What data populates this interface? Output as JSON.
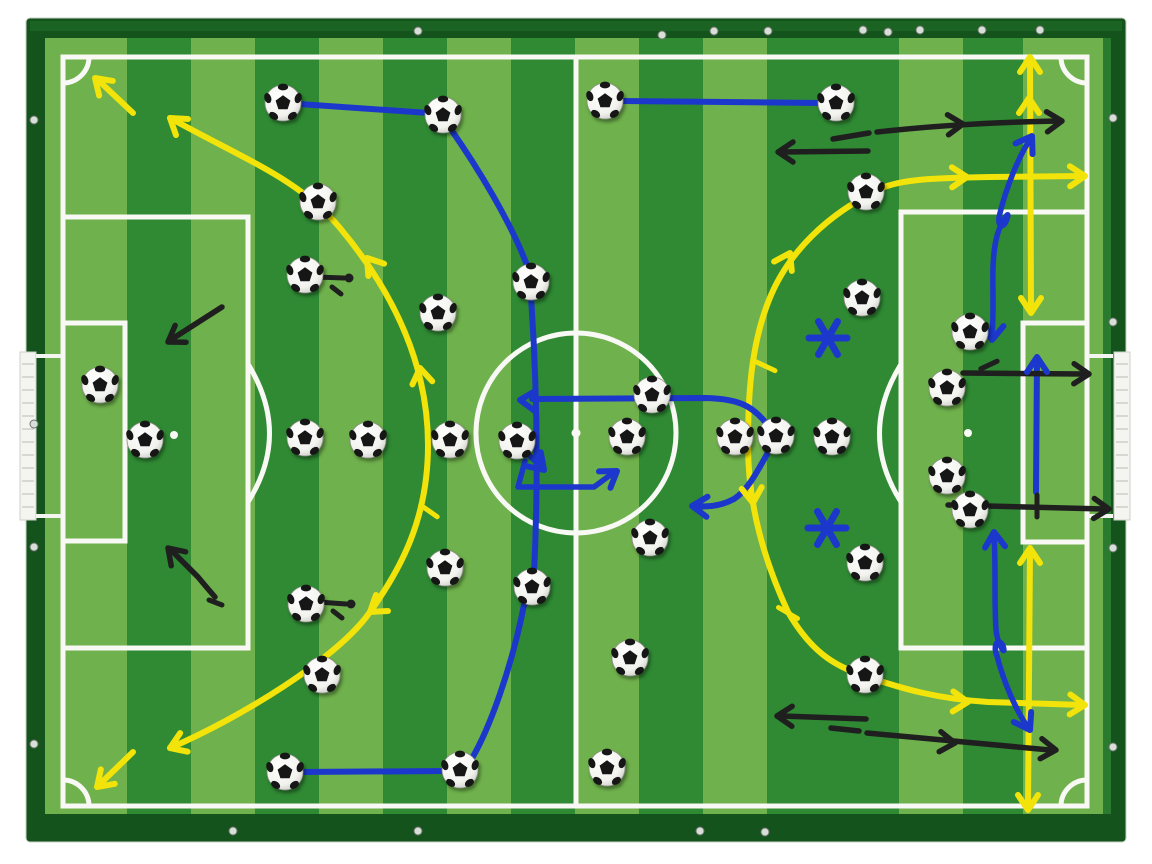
{
  "scene": {
    "type": "magnetic football tactics board photographed from above",
    "background": "#ffffff"
  },
  "palette": {
    "frame_dark": "#14531c",
    "frame_mid": "#1a6322",
    "frame_highlight": "#2a7a30",
    "stripe_light": "#6fb14c",
    "stripe_dark": "#2f8a33",
    "line_white": "#f8f8f4",
    "yellow": "#f2e30a",
    "blue": "#1c38cc",
    "black": "#1f1f1f",
    "screw": "#d8ded8",
    "goal_white": "#f4f4f0",
    "goal_hatch": "#b9bdb4"
  },
  "board": {
    "frame": [
      26,
      18,
      1100,
      824
    ],
    "surface": [
      45,
      38,
      1058,
      776
    ],
    "stripe_boundaries": [
      45,
      127,
      191,
      255,
      319,
      383,
      447,
      511,
      575,
      639,
      703,
      767,
      831,
      899,
      963,
      1023,
      1103
    ],
    "stripe_colors": [
      "L",
      "D",
      "L",
      "D",
      "L",
      "D",
      "L",
      "D",
      "L",
      "D",
      "L",
      "D",
      "D",
      "L",
      "D",
      "L"
    ]
  },
  "pitch": {
    "border": [
      63,
      57,
      1024,
      749
    ],
    "center_line_x": 576,
    "center_circle": [
      576,
      433,
      100
    ],
    "center_spot": [
      576,
      433
    ],
    "penalty_left": [
      63,
      217,
      185,
      431
    ],
    "goal_area_left": [
      63,
      323,
      62,
      218
    ],
    "penalty_right": [
      901,
      212,
      186,
      436
    ],
    "goal_area_right": [
      1023,
      323,
      64,
      219
    ],
    "penalty_spot_left": [
      174,
      435
    ],
    "penalty_spot_right": [
      968,
      433
    ],
    "arc_left": "M248,364 Q291,434 248,502",
    "arc_right": "M901,364 Q858,434 901,502",
    "corner_radius": 26
  },
  "goals": {
    "left": {
      "bar": [
        20,
        352,
        16,
        168
      ],
      "rails": [
        [
          36,
          356,
          62,
          356
        ],
        [
          36,
          516,
          62,
          516
        ]
      ]
    },
    "right": {
      "bar": [
        1114,
        352,
        16,
        168
      ],
      "rails": [
        [
          1088,
          356,
          1113,
          356
        ],
        [
          1088,
          516,
          1113,
          516
        ]
      ]
    }
  },
  "balls": [
    [
      283,
      103
    ],
    [
      443,
      115
    ],
    [
      605,
      101
    ],
    [
      836,
      103
    ],
    [
      318,
      202
    ],
    [
      866,
      192
    ],
    [
      305,
      275
    ],
    [
      531,
      282
    ],
    [
      862,
      298
    ],
    [
      100,
      385
    ],
    [
      145,
      440
    ],
    [
      438,
      313
    ],
    [
      305,
      438
    ],
    [
      368,
      440
    ],
    [
      450,
      440
    ],
    [
      517,
      441
    ],
    [
      627,
      437
    ],
    [
      652,
      395
    ],
    [
      650,
      538
    ],
    [
      735,
      437
    ],
    [
      776,
      436
    ],
    [
      832,
      437
    ],
    [
      970,
      332
    ],
    [
      947,
      388
    ],
    [
      947,
      476
    ],
    [
      970,
      510
    ],
    [
      865,
      563
    ],
    [
      445,
      568
    ],
    [
      532,
      587
    ],
    [
      630,
      658
    ],
    [
      322,
      675
    ],
    [
      865,
      675
    ],
    [
      306,
      604
    ],
    [
      285,
      772
    ],
    [
      460,
      770
    ],
    [
      607,
      768
    ]
  ],
  "screws": [
    [
      418,
      31
    ],
    [
      662,
      35
    ],
    [
      714,
      31
    ],
    [
      768,
      31
    ],
    [
      863,
      30
    ],
    [
      888,
      32
    ],
    [
      920,
      30
    ],
    [
      982,
      30
    ],
    [
      1040,
      30
    ],
    [
      34,
      120
    ],
    [
      34,
      424
    ],
    [
      34,
      547
    ],
    [
      34,
      744
    ],
    [
      1113,
      118
    ],
    [
      1113,
      322
    ],
    [
      1113,
      548
    ],
    [
      1113,
      747
    ],
    [
      233,
      831
    ],
    [
      418,
      831
    ],
    [
      700,
      831
    ],
    [
      765,
      832
    ]
  ],
  "annotations": {
    "paths": [
      {
        "id": "yellow-arc-left",
        "color": "yellow",
        "w": 6,
        "d": "M170,118 C250,162 300,180 340,228 C380,276 428,350 428,445 C428,520 400,570 370,612 C338,658 240,718 170,748"
      },
      {
        "id": "yellow-corner-arrow-top-left",
        "color": "yellow",
        "w": 6,
        "d": "M133,113 L98,80"
      },
      {
        "id": "yellow-corner-arrow-bottom-left",
        "color": "yellow",
        "w": 6,
        "d": "M133,752 L100,784"
      },
      {
        "id": "yellow-arc-right",
        "color": "yellow",
        "w": 6,
        "d": "M1083,176 L990,177 C935,178 898,179 878,190 C828,214 788,252 769,300 C751,345 748,395 748,445 C748,505 764,560 788,612 C810,650 833,666 865,676 C903,689 938,699 988,702 L1083,705"
      },
      {
        "id": "yellow-vertical-arrow-top-right",
        "color": "yellow",
        "w": 6,
        "d": "M1030,60 L1031,310"
      },
      {
        "id": "yellow-vertical-arrow-bottom-right",
        "color": "yellow",
        "w": 6,
        "d": "M1030,551 L1028,806"
      },
      {
        "id": "blue-pass-1",
        "color": "blue",
        "w": 6,
        "d": "M299,104 L429,113"
      },
      {
        "id": "blue-pass-2",
        "color": "blue",
        "w": 6,
        "d": "M450,128 C478,168 512,224 528,268"
      },
      {
        "id": "blue-run-center",
        "color": "blue",
        "w": 6,
        "d": "M531,296 C536,370 539,470 534,574"
      },
      {
        "id": "blue-run-center-2",
        "color": "blue",
        "w": 6,
        "d": "M525,600 C512,668 489,730 471,760"
      },
      {
        "id": "blue-pass-bottom-left",
        "color": "blue",
        "w": 6,
        "d": "M446,771 L299,772"
      },
      {
        "id": "blue-pass-top",
        "color": "blue",
        "w": 6,
        "d": "M622,101 L820,103"
      },
      {
        "id": "blue-arrow-midfield",
        "color": "blue",
        "w": 6,
        "d": "M771,429 C753,406 741,399 706,398 L532,399"
      },
      {
        "id": "blue-arrow-dropback",
        "color": "blue",
        "w": 6,
        "d": "M771,447 C757,472 748,490 734,499 C719,507 706,507 697,506"
      },
      {
        "id": "blue-zigzag-a",
        "color": "blue",
        "w": 5.5,
        "d": "M527,453 L541,467"
      },
      {
        "id": "blue-zigzag-b",
        "color": "blue",
        "w": 5.5,
        "d": "M525,461 L518,487 L594,487 L613,473"
      },
      {
        "id": "blue-squiggle-top-right",
        "color": "blue",
        "w": 5.5,
        "d": "M992,335 C995,302 990,268 996,240 C1000,222 1011,207 1007,219 C1003,231 996,226 1000,213 C1006,189 1018,157 1030,140"
      },
      {
        "id": "blue-arrow-goalmouth",
        "color": "blue",
        "w": 6,
        "d": "M1036,492 L1037,360"
      },
      {
        "id": "blue-squiggle-bottom-right",
        "color": "blue",
        "w": 5.5,
        "d": "M994,536 C996,566 994,600 996,630 C998,647 1007,657 1003,646 C999,637 992,644 997,656 C1004,683 1016,710 1027,726"
      },
      {
        "id": "black-dash-top",
        "color": "black",
        "w": 5.5,
        "d": "M833,139 L869,133"
      },
      {
        "id": "black-arrow-top-right",
        "color": "black",
        "w": 5.5,
        "d": "M877,132 C940,125 1000,122 1058,121"
      },
      {
        "id": "black-arrow-top-left-of-pair",
        "color": "black",
        "w": 5.5,
        "d": "M868,151 L782,152"
      },
      {
        "id": "black-arrow-left-upper",
        "color": "black",
        "w": 5.5,
        "d": "M222,307 L172,339"
      },
      {
        "id": "black-arrow-left-lower",
        "color": "black",
        "w": 5.5,
        "d": "M215,597 C208,589 203,583 198,577 L172,551"
      },
      {
        "id": "black-foot-left-lower",
        "color": "black",
        "w": 5,
        "d": "M209,600 L222,605"
      },
      {
        "id": "black-arrow-box-upper",
        "color": "black",
        "w": 5.5,
        "d": "M963,373 L1084,374"
      },
      {
        "id": "black-arrow-box-lower",
        "color": "black",
        "w": 5.5,
        "d": "M948,505 L1104,509"
      },
      {
        "id": "black-arrow-bottom-left-of-pair",
        "color": "black",
        "w": 5.5,
        "d": "M866,719 L782,716"
      },
      {
        "id": "black-dash-bottom",
        "color": "black",
        "w": 5.5,
        "d": "M831,728 L859,731"
      },
      {
        "id": "black-arrow-bottom-right",
        "color": "black",
        "w": 5.5,
        "d": "M867,733 L1050,750"
      },
      {
        "id": "black-mark-ball-a1",
        "color": "black",
        "w": 5,
        "d": "M316,277 L344,278"
      },
      {
        "id": "black-mark-ball-a2",
        "color": "black",
        "w": 5,
        "d": "M332,287 L341,294"
      },
      {
        "id": "black-mark-ball-b1",
        "color": "black",
        "w": 5,
        "d": "M318,602 L346,604"
      },
      {
        "id": "black-mark-ball-b2",
        "color": "black",
        "w": 5,
        "d": "M333,611 L342,618"
      }
    ],
    "chevrons": [
      {
        "color": "yellow",
        "x": 95,
        "y": 78,
        "a": -137
      },
      {
        "color": "yellow",
        "x": 170,
        "y": 118,
        "a": -143
      },
      {
        "color": "yellow",
        "x": 367,
        "y": 258,
        "a": -128
      },
      {
        "color": "yellow",
        "x": 420,
        "y": 368,
        "a": -99
      },
      {
        "color": "yellow",
        "x": 97,
        "y": 787,
        "a": 136
      },
      {
        "color": "yellow",
        "x": 170,
        "y": 748,
        "a": 158
      },
      {
        "color": "yellow",
        "x": 370,
        "y": 612,
        "a": 143
      },
      {
        "color": "yellow",
        "x": 1085,
        "y": 176,
        "a": -1
      },
      {
        "color": "yellow",
        "x": 967,
        "y": 177,
        "a": -1
      },
      {
        "color": "yellow",
        "x": 790,
        "y": 253,
        "a": -62
      },
      {
        "color": "yellow",
        "x": 753,
        "y": 503,
        "a": 85
      },
      {
        "color": "yellow",
        "x": 968,
        "y": 702,
        "a": 2
      },
      {
        "color": "yellow",
        "x": 1085,
        "y": 705,
        "a": 2
      },
      {
        "color": "yellow",
        "x": 1030,
        "y": 57,
        "a": -90
      },
      {
        "color": "yellow",
        "x": 1029,
        "y": 98,
        "a": -90
      },
      {
        "color": "yellow",
        "x": 1031,
        "y": 313,
        "a": 90
      },
      {
        "color": "yellow",
        "x": 1030,
        "y": 548,
        "a": -90
      },
      {
        "color": "yellow",
        "x": 1028,
        "y": 810,
        "a": 90
      },
      {
        "color": "blue",
        "x": 520,
        "y": 400,
        "a": 183
      },
      {
        "color": "blue",
        "x": 692,
        "y": 506,
        "a": 183
      },
      {
        "color": "blue",
        "x": 544,
        "y": 470,
        "a": 46
      },
      {
        "color": "blue",
        "x": 617,
        "y": 471,
        "a": -35
      },
      {
        "color": "blue",
        "x": 992,
        "y": 340,
        "a": 96
      },
      {
        "color": "blue",
        "x": 1032,
        "y": 136,
        "a": -58
      },
      {
        "color": "blue",
        "x": 1037,
        "y": 357,
        "a": -90
      },
      {
        "color": "blue",
        "x": 994,
        "y": 532,
        "a": -94
      },
      {
        "color": "blue",
        "x": 1030,
        "y": 730,
        "a": 60
      },
      {
        "color": "black",
        "x": 963,
        "y": 124,
        "a": -3
      },
      {
        "color": "black",
        "x": 1062,
        "y": 121,
        "a": -3
      },
      {
        "color": "black",
        "x": 778,
        "y": 152,
        "a": 180
      },
      {
        "color": "black",
        "x": 168,
        "y": 342,
        "a": 147
      },
      {
        "color": "black",
        "x": 168,
        "y": 548,
        "a": -134
      },
      {
        "color": "black",
        "x": 1089,
        "y": 374,
        "a": 1
      },
      {
        "color": "black",
        "x": 1109,
        "y": 509,
        "a": 2
      },
      {
        "color": "black",
        "x": 777,
        "y": 716,
        "a": 181
      },
      {
        "color": "black",
        "x": 955,
        "y": 743,
        "a": 5
      },
      {
        "color": "black",
        "x": 1056,
        "y": 750,
        "a": 5
      }
    ],
    "ticks": [
      {
        "color": "yellow",
        "x": 765,
        "y": 366,
        "a": 25,
        "len": 22
      },
      {
        "color": "yellow",
        "x": 788,
        "y": 613,
        "a": 30,
        "len": 22
      },
      {
        "color": "yellow",
        "x": 429,
        "y": 511,
        "a": 35,
        "len": 20
      },
      {
        "color": "black",
        "x": 989,
        "y": 365,
        "a": -25,
        "len": 18
      },
      {
        "color": "black",
        "x": 1037,
        "y": 506,
        "a": 90,
        "len": 22
      }
    ],
    "dots": [
      {
        "color": "black",
        "x": 349,
        "y": 278,
        "r": 4.5
      },
      {
        "color": "black",
        "x": 351,
        "y": 604,
        "r": 4.5
      }
    ],
    "asterisks": [
      {
        "color": "blue",
        "x": 828,
        "y": 338,
        "arm": 19,
        "w": 7
      },
      {
        "color": "blue",
        "x": 827,
        "y": 528,
        "arm": 19,
        "w": 7
      }
    ]
  },
  "counts": {
    "balls": 36,
    "asterisks": 2
  }
}
